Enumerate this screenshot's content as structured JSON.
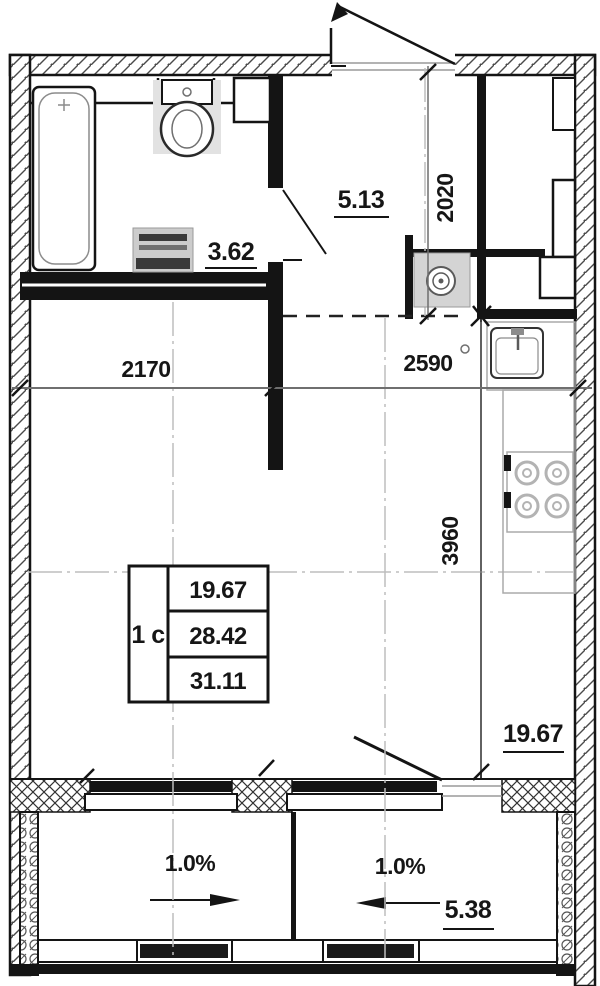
{
  "plan": {
    "apartment_type": "1 с",
    "areas": {
      "bathroom": "3.62",
      "hallway": "5.13",
      "kitchen_living": "19.67",
      "balcony": "5.38"
    },
    "table": {
      "living": "19.67",
      "without_balcony": "28.42",
      "total": "31.11"
    },
    "dims": {
      "alcove_width": "2170",
      "kitchen_width": "2590",
      "hallway_depth": "2020",
      "room_depth": "3960"
    },
    "slopes": {
      "left": "1.0%",
      "right": "1.0%"
    },
    "colors": {
      "line": "#141414",
      "fixture_gray": "#cccccc",
      "centerline": "#bdbdbd",
      "dim_line": "#6f6f6f"
    }
  }
}
